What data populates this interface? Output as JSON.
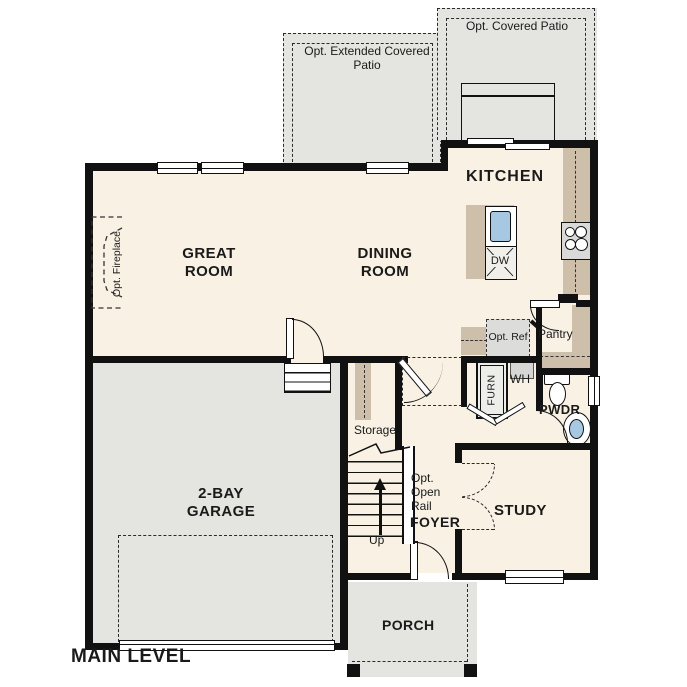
{
  "plan_title": "MAIN LEVEL",
  "rooms": {
    "great_room": "GREAT ROOM",
    "dining_room": "DINING ROOM",
    "kitchen": "KITCHEN",
    "garage": "2-BAY GARAGE",
    "foyer": "FOYER",
    "study": "STUDY",
    "powder_room": "PWDR",
    "pantry": "Pantry",
    "storage": "Storage",
    "porch": "PORCH"
  },
  "optional_features": {
    "covered_patio": "Opt. Covered Patio",
    "extended_covered_patio": "Opt. Extended Covered Patio",
    "fireplace": "Opt. Fireplace",
    "open_rail": "Opt. Open Rail",
    "refrigerator": "Opt. Ref"
  },
  "fixtures": {
    "dishwasher": "DW",
    "water_heater": "WH",
    "furnace": "FURN",
    "stair_direction": "Up"
  },
  "colors": {
    "wall": "#111111",
    "interior_floor": "#f8f1e4",
    "exterior_concrete": "#e4e4e1",
    "cabinetry": "#cdbfa9",
    "fixture_blue": "#a7c8e2"
  }
}
